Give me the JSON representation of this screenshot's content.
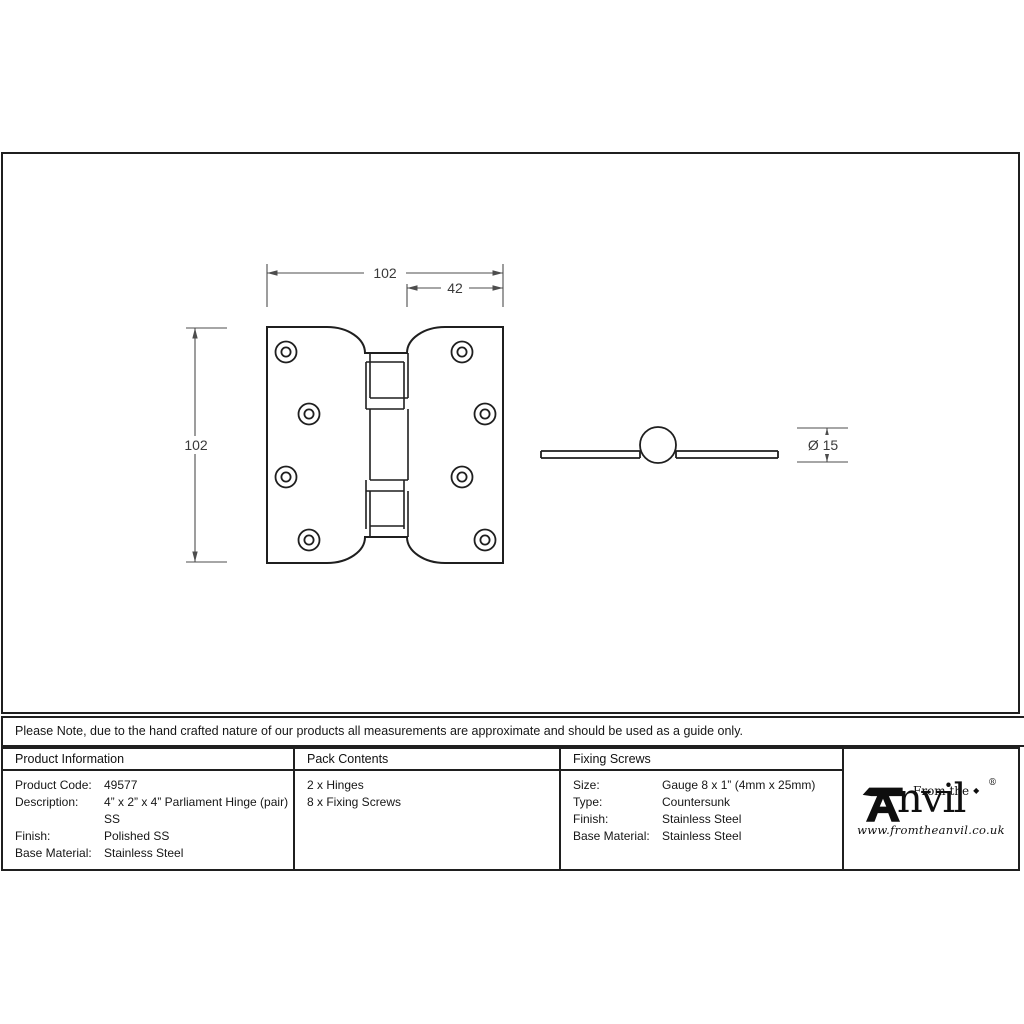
{
  "drawing": {
    "dim_width": "102",
    "dim_sub_width": "42",
    "dim_height": "102",
    "dim_diameter": "Ø 15"
  },
  "note": {
    "text": "Please Note, due to the hand crafted nature of our products all measurements are approximate and should be used as a guide only."
  },
  "table": {
    "product_information": {
      "header": "Product Information",
      "rows": [
        {
          "label": "Product Code:",
          "value": "49577"
        },
        {
          "label": "Description:",
          "value": "4” x 2” x 4” Parliament Hinge (pair)\nSS"
        },
        {
          "label": "Finish:",
          "value": "Polished SS"
        },
        {
          "label": "Base Material:",
          "value": "Stainless Steel"
        }
      ]
    },
    "pack_contents": {
      "header": "Pack Contents",
      "items": [
        "2 x Hinges",
        "8 x Fixing Screws"
      ]
    },
    "fixing_screws": {
      "header": "Fixing Screws",
      "rows": [
        {
          "label": "Size:",
          "value": "Gauge 8 x 1” (4mm x 25mm)"
        },
        {
          "label": "Type:",
          "value": "Countersunk"
        },
        {
          "label": "Finish:",
          "value": "Stainless Steel"
        },
        {
          "label": "Base Material:",
          "value": "Stainless Steel"
        }
      ]
    }
  },
  "logo": {
    "prefix": "From the",
    "diamond": "◆",
    "wordmark": "nvil",
    "brand": "Anvil",
    "registered": "®",
    "url": "www.fromtheanvil.co.uk"
  },
  "colors": {
    "outline": "#1f1f1f",
    "dimension": "#4d4d4d",
    "dim_text": "#3a3a3a"
  }
}
